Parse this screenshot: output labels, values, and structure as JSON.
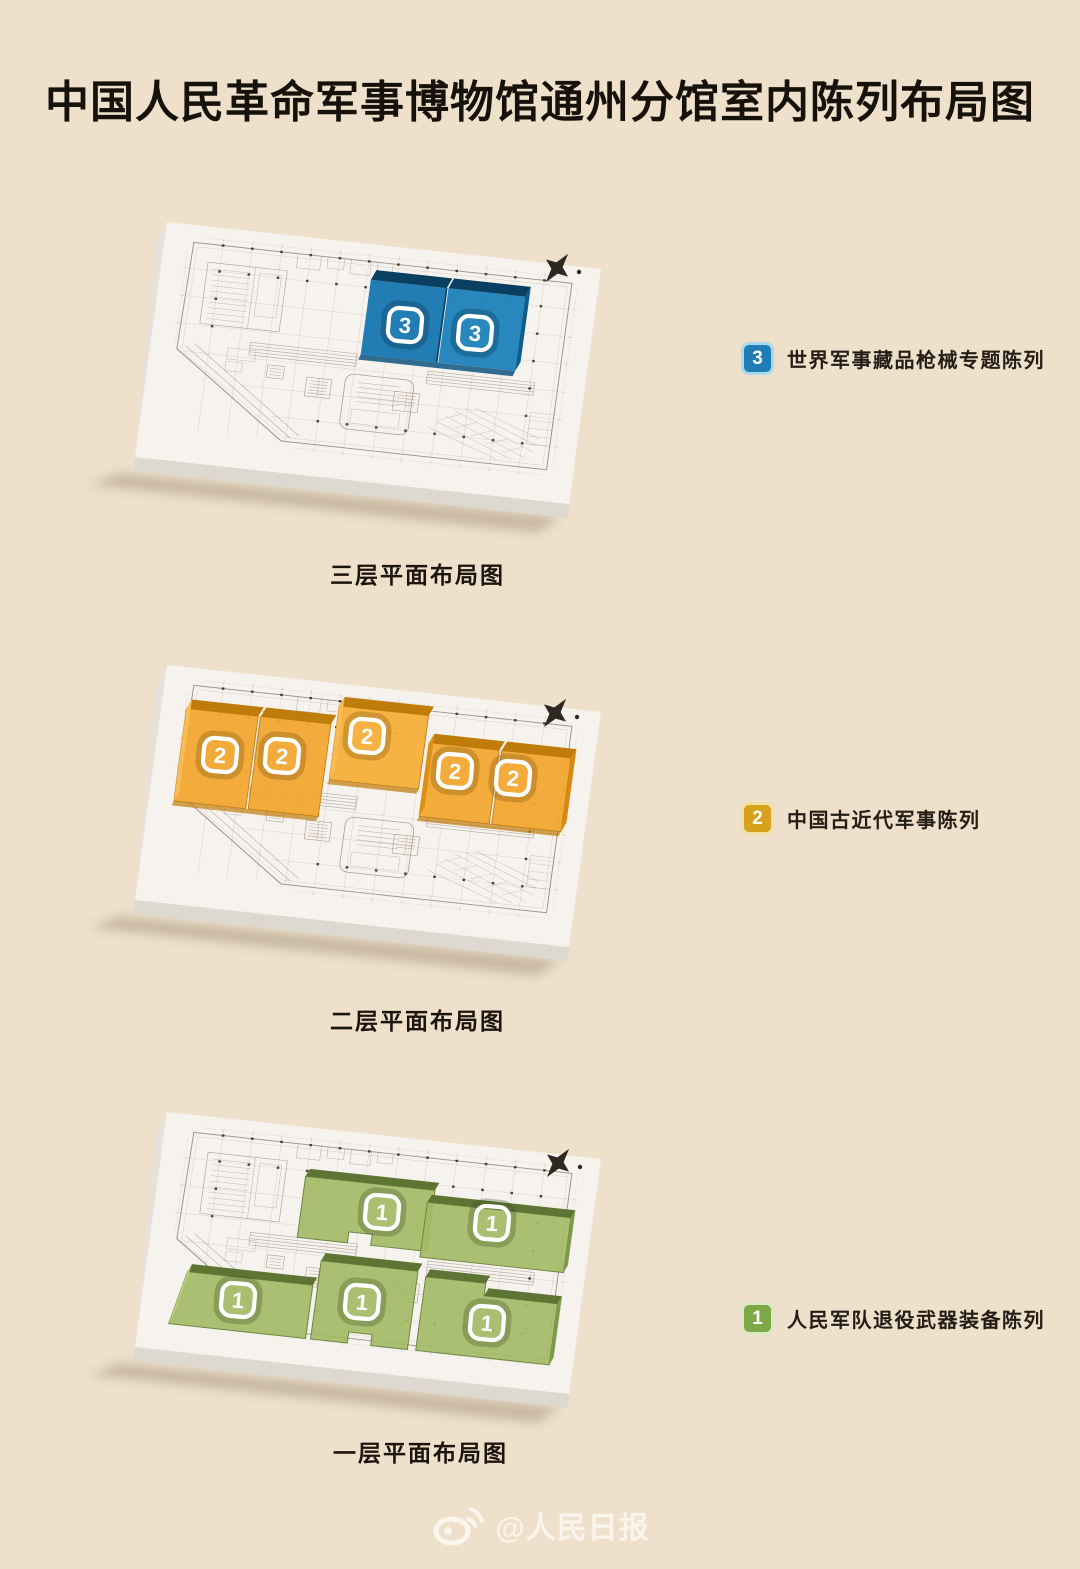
{
  "title": "中国人民革命军事博物馆通州分馆室内陈列布局图",
  "floors": [
    {
      "name": "floor-3",
      "caption": "三层平面布局图",
      "legend_number": "3",
      "legend_label": "世界军事藏品枪械专题陈列",
      "color": "#1878b0",
      "markers": [
        "3",
        "3"
      ]
    },
    {
      "name": "floor-2",
      "caption": "二层平面布局图",
      "legend_number": "2",
      "legend_label": "中国古近代军事陈列",
      "color": "#f2a62e",
      "markers": [
        "2",
        "2",
        "2",
        "2",
        "2"
      ]
    },
    {
      "name": "floor-1",
      "caption": "一层平面布局图",
      "legend_number": "1",
      "legend_label": "人民军队退役武器装备陈列",
      "color": "#a3bb66",
      "markers": [
        "1",
        "1",
        "1",
        "1",
        "1"
      ]
    }
  ],
  "watermark": {
    "icon": "weibo-icon",
    "source_label": "@人民日报"
  },
  "colors": {
    "background": "#eee0ca",
    "floor3_blue": "#1878b0",
    "floor2_orange": "#f2a62e",
    "floor1_green": "#a3bb66",
    "board_white": "#f6f3ee"
  }
}
